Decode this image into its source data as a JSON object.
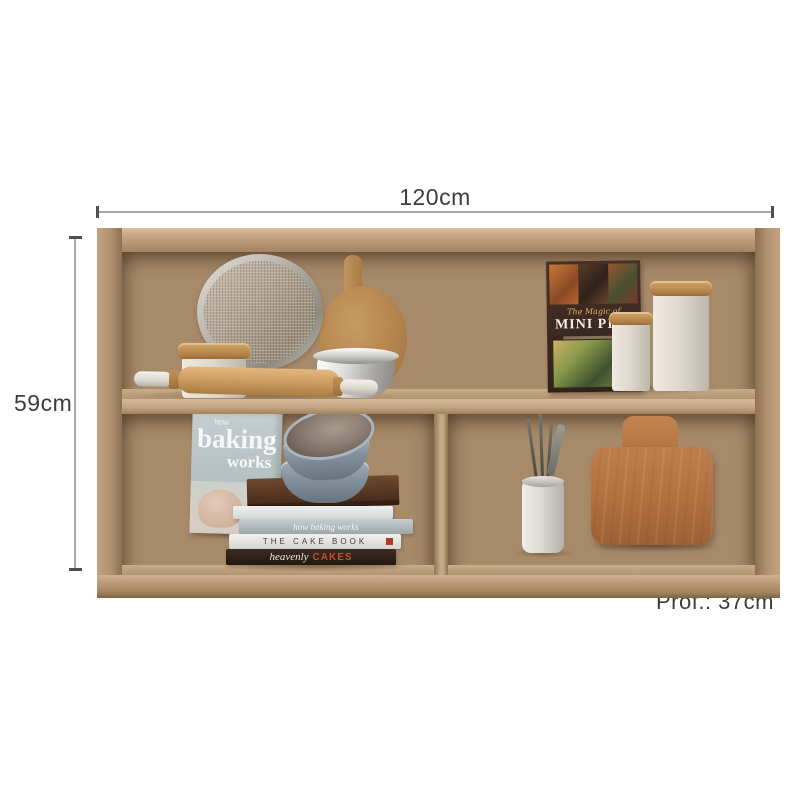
{
  "scene": {
    "type": "furniture-dimension-diagram",
    "background": "#ffffff"
  },
  "annotations": {
    "width_label": "120cm",
    "height_label": "59cm",
    "depth_label": "Prof.: 37cm",
    "line_color": "#a9a9a9",
    "tick_color": "#4f4f4f",
    "text_color": "#3d3d3d"
  },
  "cabinet": {
    "colors": {
      "frame_light": "#dcc2a0",
      "frame_mid": "#b6957a",
      "frame_dark": "#8d7052",
      "interior_back": "#a78a6a",
      "shelf_edge": "#d6bb99",
      "cutting_board_wood": "#b0703f",
      "lid_wood": "#b5834a"
    }
  },
  "decor": {
    "mini_pies_book": {
      "script_title": "The Magic of",
      "title": "MINI PIES"
    },
    "baking_works_book": {
      "overline": "how",
      "title_line1": "baking",
      "title_line2": "works"
    },
    "book_stack": {
      "spine_blank": "",
      "spine_gray": "how baking works",
      "spine_white": "THE CAKE BOOK",
      "spine_dark_word1": "heavenly",
      "spine_dark_word2": "CAKES"
    }
  }
}
